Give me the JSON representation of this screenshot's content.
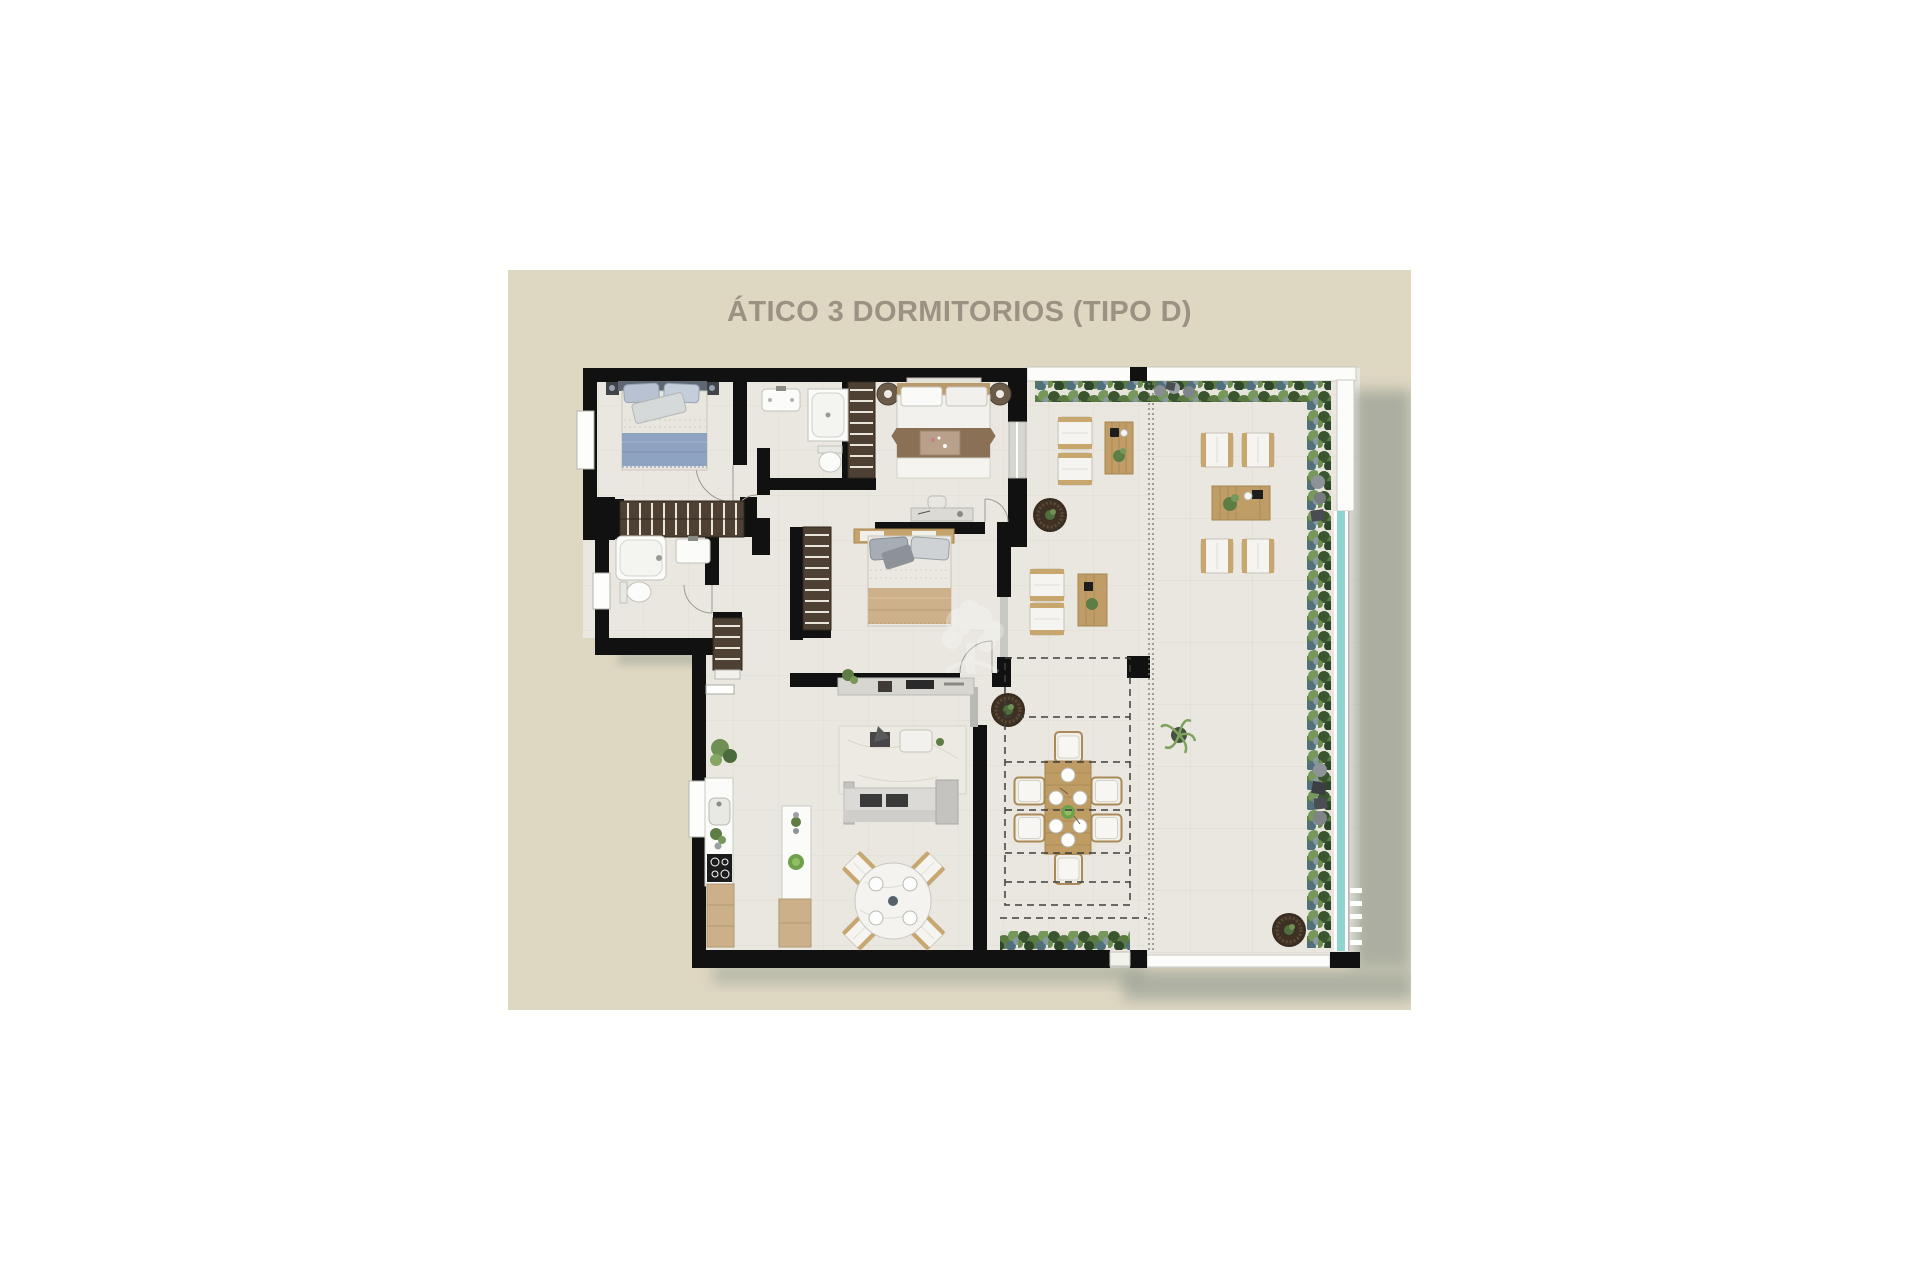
{
  "panel": {
    "title": "ÁTICO 3 DORMITORIOS (TIPO D)"
  },
  "colors": {
    "page_bg": "#ffffff",
    "panel_bg": "#ded7c2",
    "title_text": "#9c9283",
    "walls": "#111111",
    "floor": "#eae7e0",
    "wood_furniture": "#c09d66",
    "wardrobe_brown": "#4e4134",
    "pool_teal": "#8fd4d0",
    "building_shadow": "#9aa195",
    "plant_dark": "#3a5530",
    "plant_light": "#76985b",
    "bed_blue": "#8ea3c1",
    "bed_tan": "#ccb18b",
    "white_fixture": "#fbfbf9"
  },
  "plan": {
    "type": "floor-plan",
    "rooms": [
      "bedroom-1",
      "bathroom-1",
      "bedroom-2",
      "bathroom-2",
      "bedroom-3",
      "hallway",
      "kitchen",
      "living-dining-room",
      "terrace-lounge",
      "terrace-dining",
      "solarium-terrace"
    ]
  }
}
